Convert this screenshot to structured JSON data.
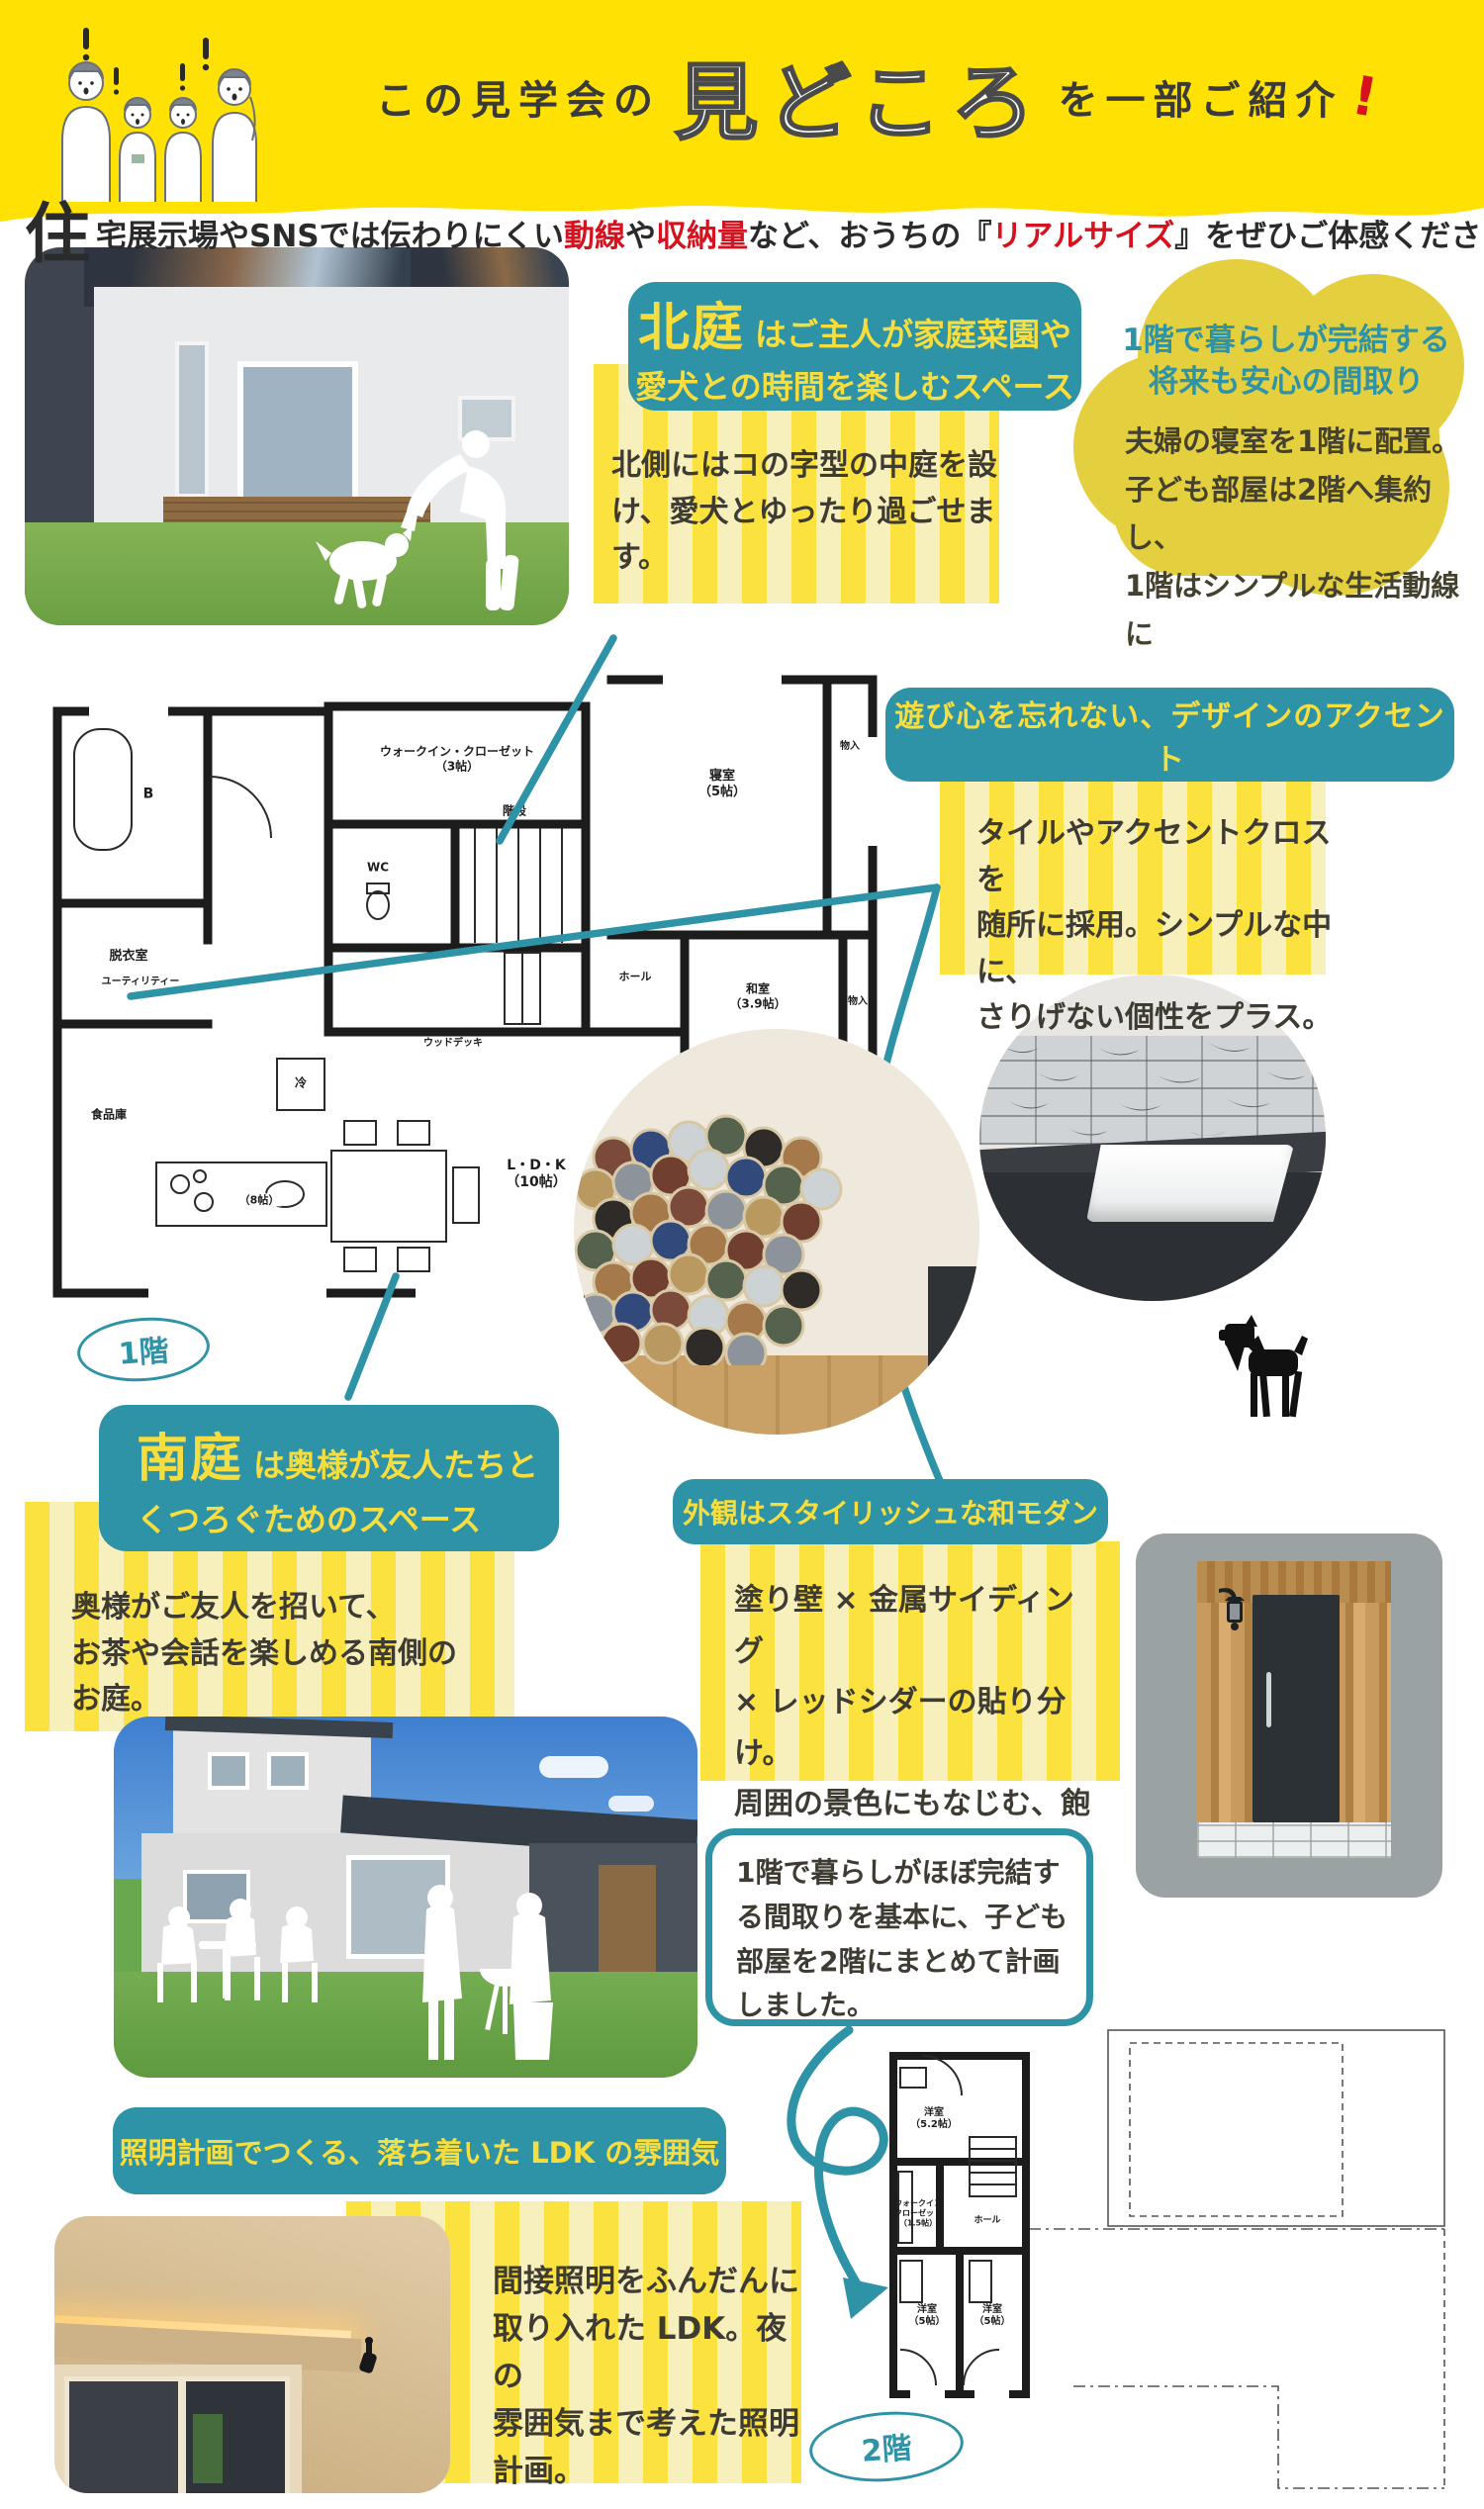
{
  "colors": {
    "banner_yellow": "#ffe203",
    "teal": "#2e93a6",
    "callout_text_yellow": "#f7de3e",
    "stripe_bright": "#fbe23e",
    "stripe_pale": "#f8f0bc",
    "accent_red": "#d5121e",
    "cloud_yellow": "#e4d03e",
    "body_text": "#3e3b33"
  },
  "header": {
    "prefix": "この見学会の",
    "highlight": "見どころ",
    "suffix": "を一部ご紹介",
    "bang": "!"
  },
  "intro": {
    "dropcap": "住",
    "seg1": "宅展示場やSNSでは伝わりにくい",
    "red1": "動線",
    "seg2": "や",
    "red2": "収納量",
    "seg3": "など、おうちの",
    "bracket_open": "『",
    "red3": "リアルサイズ",
    "bracket_close": "』",
    "seg4": "をぜひご体感ください"
  },
  "north_garden": {
    "title_em": "北庭",
    "title_rest": "はご主人が家庭菜園や",
    "title_line2": "愛犬との時間を楽しむスペース",
    "body": "北側にはコの字型の中庭を設\nけ、愛犬とゆったり過ごせま\nす。"
  },
  "cloud": {
    "title": "1階で暮らしが完結する\n将来も安心の間取り",
    "body": "夫婦の寝室を1階に配置。\n子ども部屋は2階へ集約し、\n1階はシンプルな生活動線に"
  },
  "accent": {
    "title": "遊び心を忘れない、デザインのアクセント",
    "body": "タイルやアクセントクロスを\n随所に採用。シンプルな中に、\nさりげない個性をプラス。"
  },
  "south_garden": {
    "title_em": "南庭",
    "title_rest": "は奥様が友人たちと",
    "title_line2": "くつろぐためのスペース",
    "body": "奥様がご友人を招いて、\nお茶や会話を楽しめる南側の\nお庭。"
  },
  "exterior": {
    "title": "外観はスタイリッシュな和モダン",
    "body": "塗り壁 × 金属サイディング\n× レッドシダーの貼り分け。\n周囲の景色にもなじむ、飽き\nのこない外観デザイン。"
  },
  "bubble": {
    "text": "1階で暮らしがほぼ完結す\nる間取りを基本に、子ども\n部屋を2階にまとめて計画\nしました。"
  },
  "lighting": {
    "title": "照明計画でつくる、落ち着いた LDK の雰囲気",
    "body": "間接照明をふんだんに\n取り入れた LDK。夜の\n雰囲気まで考えた照明\n計画。"
  },
  "floor1": {
    "label": "1階",
    "rooms": [
      "B",
      "脱衣室",
      "ウォークイン・クローゼット\n（3帖）",
      "WC",
      "階段",
      "ユーティリティー",
      "食品庫",
      "冷",
      "ウッドデッキ",
      "ホール",
      "寝室\n（5帖）",
      "物入",
      "和室\n（3.9帖）",
      "物入",
      "L・D・K\n（10帖）",
      "（8帖）",
      "ホール",
      "WC",
      "玄関",
      "玄関収納",
      "ポーチ"
    ]
  },
  "floor2": {
    "label": "2階",
    "rooms": [
      "洋室\n（5.2帖）",
      "ウォークイン\nクローゼット\n（1.5帖）",
      "ホール",
      "洋室\n（5帖）",
      "洋室\n（5帖）"
    ]
  }
}
